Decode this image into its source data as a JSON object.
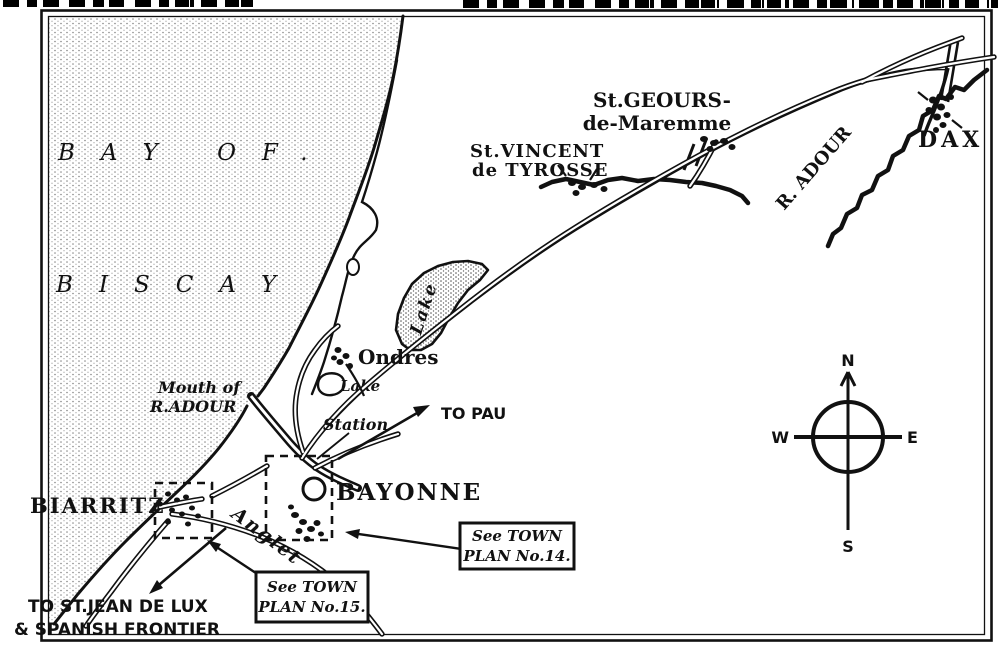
{
  "sea": {
    "name_line1": "BAY OF.",
    "name_line2": "BISCAY"
  },
  "places": {
    "st_geours_line1": "St.GEOURS-",
    "st_geours_line2": "de-Maremme",
    "st_vincent_line1": "St.VINCENT",
    "st_vincent_line2": "de TYROSSE",
    "dax": "DAX",
    "ondres": "Ondres",
    "bayonne": "BAYONNE",
    "biarritz": "BIARRITZ",
    "anglet": "Anglet"
  },
  "water": {
    "river_dax": "R. ADOUR",
    "mouth_line1": "Mouth of",
    "mouth_line2": "R.ADOUR",
    "lake_large": "Lake",
    "lake_small": "Lake"
  },
  "annotations": {
    "station": "Station",
    "to_pau": "TO PAU",
    "to_stjean_line1": "TO ST.JEAN DE LUX",
    "to_stjean_line2": "& SPANISH FRONTIER",
    "plan15_line1": "See TOWN",
    "plan15_line2": "PLAN No.15.",
    "plan14_line1": "See TOWN",
    "plan14_line2": "PLAN No.14."
  },
  "compass": {
    "north": "N",
    "south": "S",
    "east": "E",
    "west": "W"
  },
  "colors": {
    "ink": "#111111",
    "paper": "#ffffff",
    "stipple": "#808080"
  }
}
